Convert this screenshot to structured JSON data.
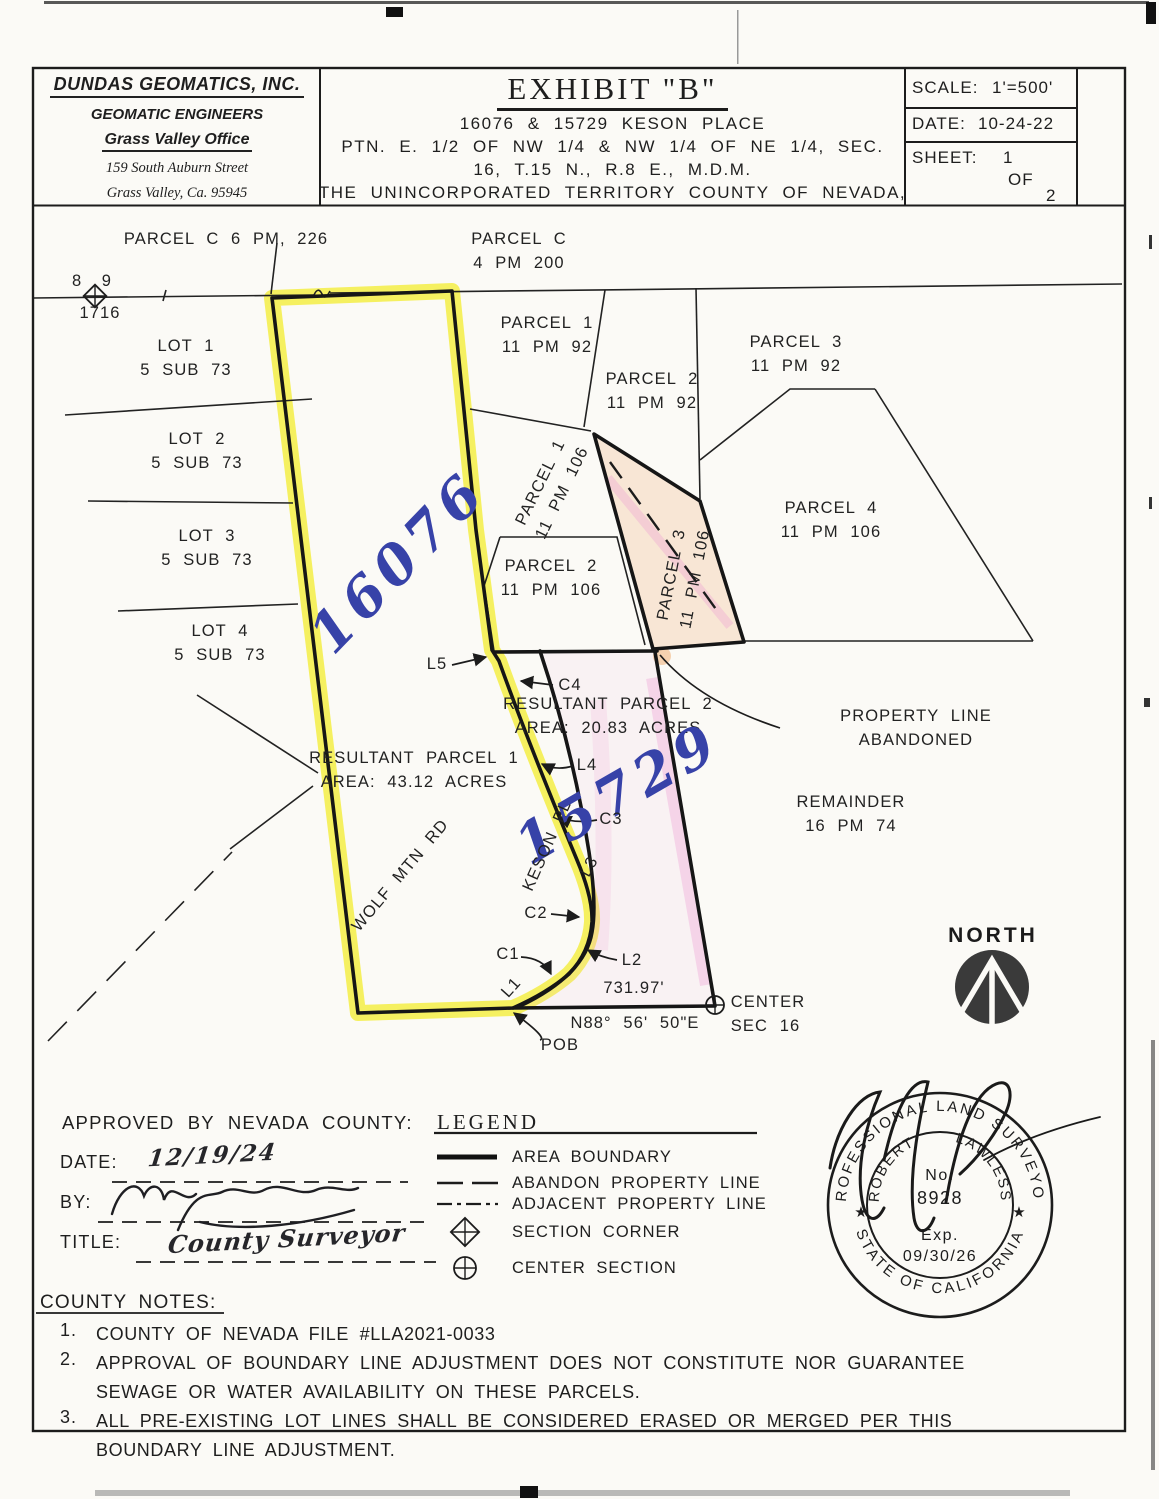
{
  "title_block": {
    "company": {
      "name": "DUNDAS GEOMATICS, INC.",
      "dept": "GEOMATIC ENGINEERS",
      "office": "Grass Valley Office",
      "address1": "159 South Auburn Street",
      "address2": "Grass Valley, Ca. 95945"
    },
    "exhibit": {
      "title": "EXHIBIT \"B\"",
      "address": "16076 & 15729 KESON PLACE",
      "legal1": "PTN. E. 1/2 OF NW 1/4  & NW 1/4 OF NE 1/4, SEC.",
      "legal2": "16, T.15 N., R.8 E., M.D.M.",
      "legal3": "THE UNINCORPORATED TERRITORY COUNTY OF NEVADA,"
    },
    "info": {
      "scale_label": "SCALE:",
      "scale_value": "1'=500'",
      "date_label": "DATE:",
      "date_value": "10-24-22",
      "sheet_label": "SHEET:",
      "sheet_value": "1",
      "of_label": "OF",
      "sheet_total": "2"
    }
  },
  "map": {
    "labels": [
      {
        "name": "label-parcel-c-6pm226",
        "text": "PARCEL C 6 PM, 226",
        "x": 226,
        "y": 240
      },
      {
        "name": "label-parcel-c-4pm200",
        "text": "PARCEL C\n4 PM 200",
        "x": 519,
        "y": 252
      },
      {
        "name": "label-corner-8-9",
        "text": "8 9",
        "x": 94,
        "y": 282,
        "cls": "sm"
      },
      {
        "name": "label-corner-1716",
        "text": "1716",
        "x": 100,
        "y": 314
      },
      {
        "name": "label-lot1",
        "text": "LOT 1\n5 SUB 73",
        "x": 186,
        "y": 359
      },
      {
        "name": "label-lot2",
        "text": "LOT 2\n5 SUB 73",
        "x": 197,
        "y": 452
      },
      {
        "name": "label-lot3",
        "text": "LOT 3\n5 SUB 73",
        "x": 207,
        "y": 549
      },
      {
        "name": "label-lot4",
        "text": "LOT 4\n5 SUB 73",
        "x": 220,
        "y": 644
      },
      {
        "name": "label-parcel1-11pm92",
        "text": "PARCEL 1\n11 PM 92",
        "x": 547,
        "y": 336
      },
      {
        "name": "label-parcel2-11pm92",
        "text": "PARCEL 2\n11 PM 92",
        "x": 652,
        "y": 392
      },
      {
        "name": "label-parcel3-11pm92",
        "text": "PARCEL 3\n11 PM 92",
        "x": 796,
        "y": 355
      },
      {
        "name": "label-parcel1-11pm106",
        "text": "PARCEL 1\n11 PM 106",
        "x": 552,
        "y": 488,
        "rot": -64
      },
      {
        "name": "label-parcel2-11pm106",
        "text": "PARCEL 2\n11 PM 106",
        "x": 551,
        "y": 579
      },
      {
        "name": "label-parcel3-11pm106",
        "text": "PARCEL 3\n11 PM 106",
        "x": 684,
        "y": 577,
        "rot": -79
      },
      {
        "name": "label-parcel4-11pm106",
        "text": "PARCEL 4\n11 PM 106",
        "x": 831,
        "y": 521
      },
      {
        "name": "handwritten-16076",
        "text": "16076",
        "x": 398,
        "y": 562,
        "rot": -46,
        "cls": "hand"
      },
      {
        "name": "label-l5",
        "text": "L5",
        "x": 437,
        "y": 665
      },
      {
        "name": "label-c4",
        "text": "C4",
        "x": 570,
        "y": 686
      },
      {
        "name": "label-resultant-parcel-2",
        "text": "RESULTANT PARCEL 2\nAREA: 20.83 ACRES",
        "x": 608,
        "y": 717
      },
      {
        "name": "label-property-line-abandoned",
        "text": "PROPERTY LINE ABANDONED",
        "x": 916,
        "y": 729
      },
      {
        "name": "label-resultant-parcel-1",
        "text": "RESULTANT PARCEL 1\nAREA: 43.12 ACRES",
        "x": 414,
        "y": 771
      },
      {
        "name": "label-l4",
        "text": "L4",
        "x": 587,
        "y": 766
      },
      {
        "name": "handwritten-15729",
        "text": "15729",
        "x": 618,
        "y": 793,
        "rot": -30,
        "cls": "hand"
      },
      {
        "name": "label-c3",
        "text": "C3",
        "x": 611,
        "y": 820
      },
      {
        "name": "label-l3",
        "text": "L3",
        "x": 590,
        "y": 867,
        "rot": -62
      },
      {
        "name": "label-keson-pl",
        "text": "KESON PL",
        "x": 548,
        "y": 846,
        "rot": -66
      },
      {
        "name": "label-wolf-mtn-rd",
        "text": "WOLF MTN RD",
        "x": 401,
        "y": 876,
        "rot": -50
      },
      {
        "name": "label-remainder",
        "text": "REMAINDER\n16 PM 74",
        "x": 851,
        "y": 815
      },
      {
        "name": "label-c2",
        "text": "C2",
        "x": 536,
        "y": 914
      },
      {
        "name": "label-c1",
        "text": "C1",
        "x": 508,
        "y": 955
      },
      {
        "name": "label-l2",
        "text": "L2",
        "x": 632,
        "y": 961
      },
      {
        "name": "label-l1",
        "text": "L1",
        "x": 512,
        "y": 988,
        "rot": -48
      },
      {
        "name": "label-dim-731-97",
        "text": "731.97'",
        "x": 634,
        "y": 989
      },
      {
        "name": "label-bearing",
        "text": "N88° 56' 50\"E",
        "x": 635,
        "y": 1024
      },
      {
        "name": "label-center-sec-16",
        "text": "CENTER\nSEC 16",
        "x": 768,
        "y": 1015,
        "cls": "left"
      },
      {
        "name": "label-pob",
        "text": "POB",
        "x": 560,
        "y": 1046
      },
      {
        "name": "label-north",
        "text": "NORTH",
        "x": 993,
        "y": 936,
        "cls": "north"
      }
    ]
  },
  "approval": {
    "heading": "APPROVED BY NEVADA COUNTY:",
    "date_label": "DATE:",
    "date_value": "12/19/24",
    "by_label": "BY:",
    "title_label": "TITLE:",
    "title_value": "County Surveyor"
  },
  "legend": {
    "title": "LEGEND",
    "items": [
      {
        "label": "AREA BOUNDARY"
      },
      {
        "label": "ABANDON PROPERTY LINE"
      },
      {
        "label": "ADJACENT PROPERTY LINE"
      },
      {
        "label": "SECTION CORNER"
      },
      {
        "label": "CENTER SECTION"
      }
    ]
  },
  "stamp": {
    "ring_top": "PROFESSIONAL LAND SURVEYOR",
    "ring_bottom": "STATE OF CALIFORNIA",
    "name": "ROBERT LAWLESS",
    "no_label": "No.",
    "license_no": "8928",
    "exp_label": "Exp.",
    "exp_date": "09/30/26",
    "star": "★"
  },
  "notes": {
    "heading": "COUNTY NOTES:",
    "items": [
      {
        "num": "1.",
        "text": "COUNTY OF NEVADA FILE #LLA2021-0033"
      },
      {
        "num": "2.",
        "text": "APPROVAL OF BOUNDARY LINE ADJUSTMENT DOES NOT CONSTITUTE NOR GUARANTEE SEWAGE OR WATER AVAILABILITY ON THESE PARCELS."
      },
      {
        "num": "3.",
        "text": "ALL PRE-EXISTING LOT LINES SHALL BE CONSIDERED ERASED OR MERGED PER THIS BOUNDARY LINE ADJUSTMENT."
      }
    ]
  },
  "colors": {
    "highlight_yellow": "#f4ee3b",
    "highlight_pink": "#ee9fd4",
    "highlight_peach": "#f3cfae",
    "ink": "#1c1c1c",
    "hand_blue": "#3742a8"
  }
}
